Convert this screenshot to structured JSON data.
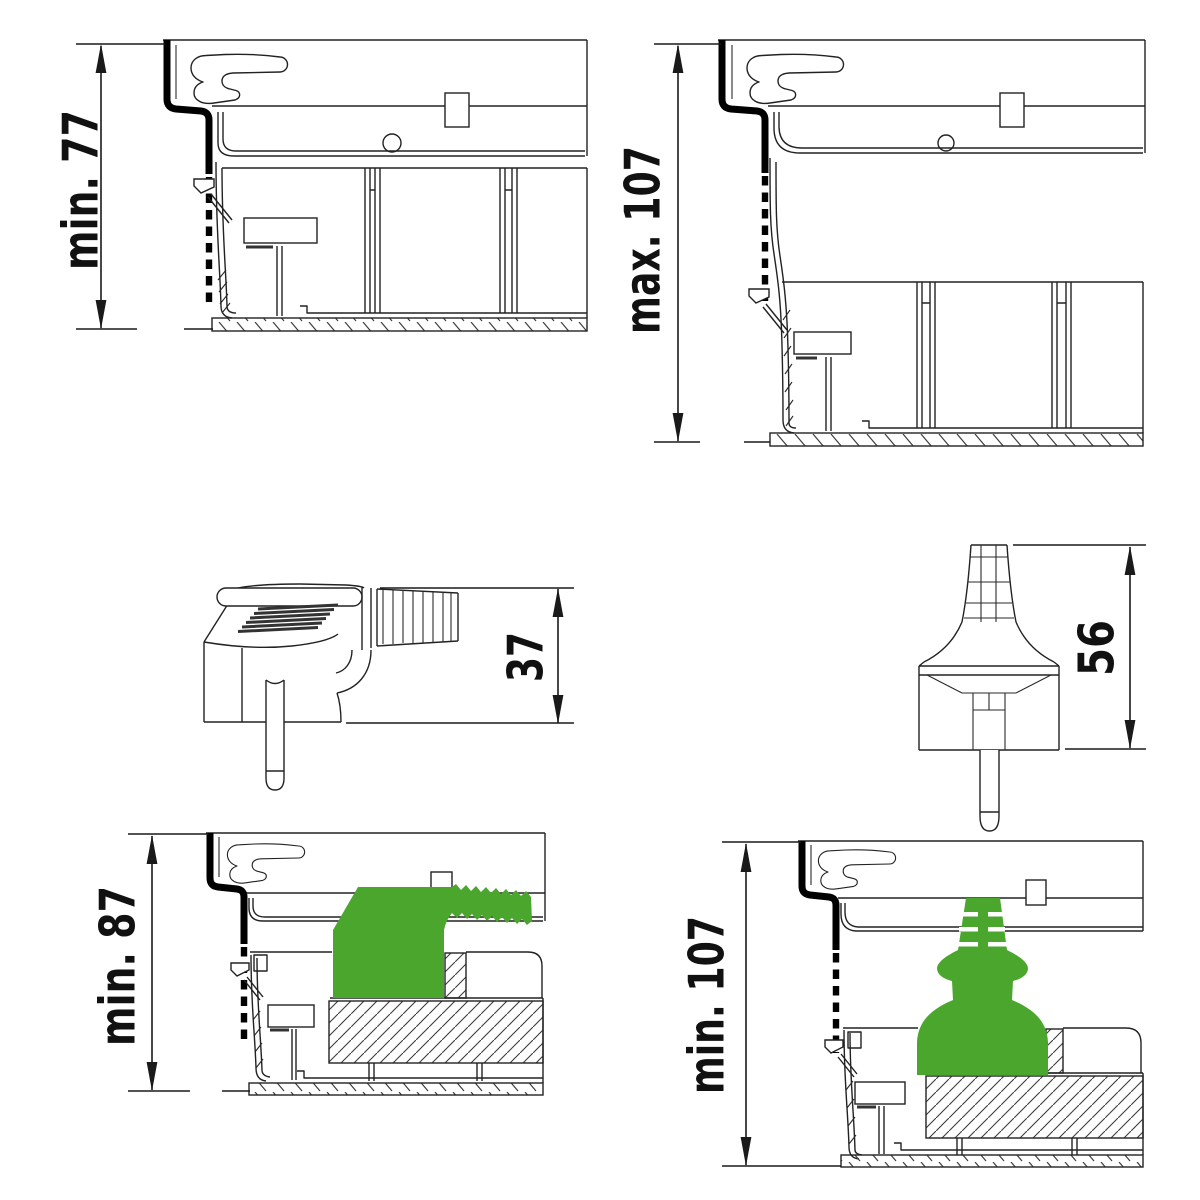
{
  "colors": {
    "highlight_green": "#4BA62E",
    "line": "#222222"
  },
  "diagrams": {
    "top_left": {
      "dimension_label": "min. 77"
    },
    "top_right": {
      "dimension_label": "max. 107"
    },
    "middle_left": {
      "dimension_label": "37"
    },
    "middle_right": {
      "dimension_label": "56"
    },
    "bottom_left": {
      "dimension_label": "min. 87"
    },
    "bottom_right": {
      "dimension_label": "min. 107"
    }
  }
}
